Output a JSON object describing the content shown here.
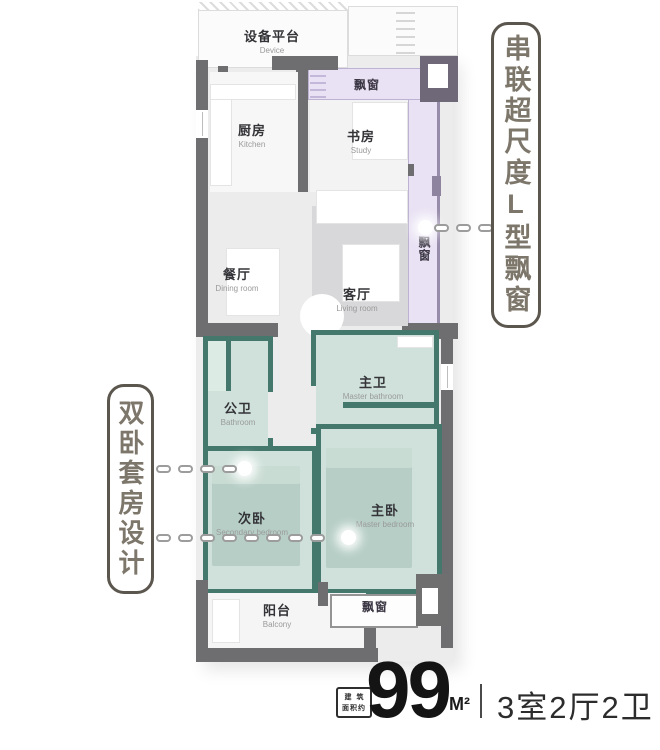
{
  "annotations": {
    "right_callout": "串联超尺度L型飘窗",
    "left_callout": "双卧套房设计"
  },
  "rooms": {
    "device_platform": {
      "name": "设备平台",
      "en": "Device"
    },
    "kitchen": {
      "name": "厨房",
      "en": "Kitchen"
    },
    "study": {
      "name": "书房",
      "en": "Study"
    },
    "dining_room": {
      "name": "餐厅",
      "en": "Dining room"
    },
    "living_room": {
      "name": "客厅",
      "en": "Living room"
    },
    "guest_bathroom": {
      "name": "公卫",
      "en": "Bathroom"
    },
    "master_bathroom": {
      "name": "主卫",
      "en": "Master bathroom"
    },
    "secondary_bedroom": {
      "name": "次卧",
      "en": "Secondary bedroom"
    },
    "master_bedroom": {
      "name": "主卧",
      "en": "Master bedroom"
    },
    "balcony": {
      "name": "阳台",
      "en": "Balcony"
    },
    "bay_window_top": {
      "name": "飘窗"
    },
    "bay_window_right": {
      "name": "飘窗"
    },
    "bay_window_bottom": {
      "name": "飘窗"
    }
  },
  "footer": {
    "area_prefix_line1": "建筑",
    "area_prefix_line2": "面积约",
    "area_value": "99",
    "area_unit": "M²",
    "huxing": "3室2厅2卫"
  },
  "colors": {
    "wall_gray": "#6e6e70",
    "teal_wall": "#44786c",
    "teal_floor": "#cfe1da",
    "bay_window_purple": "#e9e2f4",
    "purple_column": "#6f6879",
    "callout_text": "#7d766a",
    "footer_text": "#141414"
  }
}
